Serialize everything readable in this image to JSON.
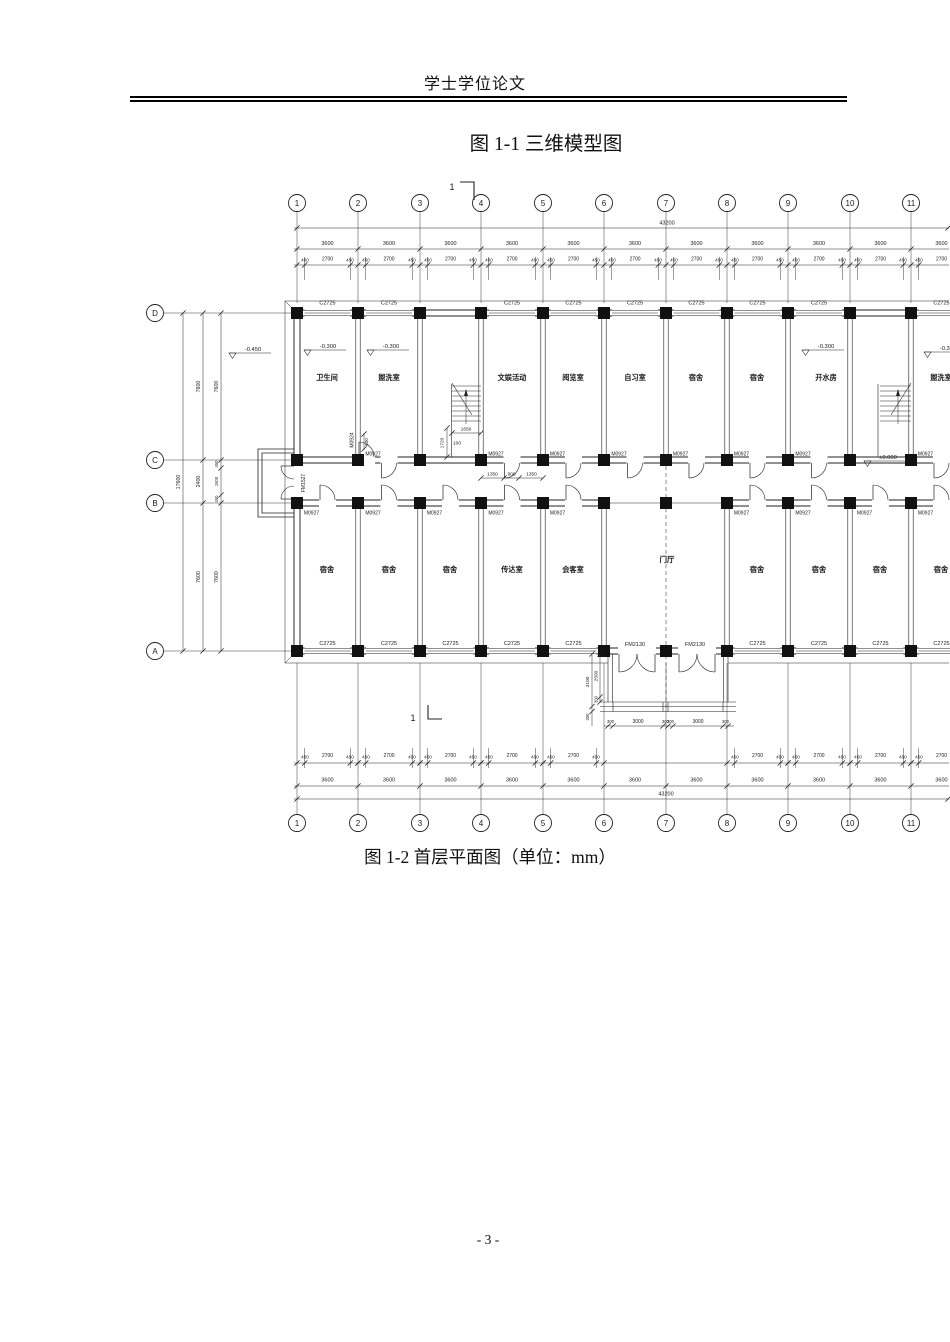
{
  "page": {
    "header_title": "学士学位论文",
    "figure1_caption": "图 1-1 三维模型图",
    "figure2_caption": "图 1-2 首层平面图（单位：mm）",
    "page_number": "- 3 -"
  },
  "plan": {
    "cols": [
      297,
      358,
      420,
      481,
      543,
      604,
      666,
      727,
      788,
      850,
      911,
      972
    ],
    "rows": {
      "D": 313,
      "C": 460,
      "B": 503,
      "A": 651
    },
    "grid_top_labels": [
      "1",
      "2",
      "3",
      "4",
      "5",
      "6",
      "7",
      "8",
      "9",
      "10",
      "11"
    ],
    "grid_left_labels": [
      "D",
      "C",
      "B",
      "A"
    ],
    "bubble_y_top": 203,
    "bubble_y_bottom": 823,
    "bubble_x_left": 155,
    "windows": {
      "label": "C2725",
      "top_centers": [
        327.5,
        389,
        512,
        573.5,
        635,
        696.5,
        757.5,
        819,
        941.5
      ],
      "bottom_centers": [
        327.5,
        389,
        450.5,
        512,
        573.5,
        757.5,
        819,
        880.5,
        941.5
      ]
    },
    "doors": {
      "label": "M0927",
      "c_wall_centers": [
        389,
        512,
        573.5,
        635,
        696.5,
        757.5,
        819,
        941.5
      ],
      "b_wall_centers": [
        327.5,
        389,
        450.5,
        512,
        573.5,
        757.5,
        819,
        880.5,
        941.5
      ]
    },
    "entry_doors": {
      "label": "FM2130",
      "centers": [
        637,
        697
      ]
    },
    "side_door_label": "FM1527",
    "aux_door_label": "M0924",
    "room_labels_top": [
      {
        "x": 327,
        "t": "卫生间"
      },
      {
        "x": 389,
        "t": "盥洗室"
      },
      {
        "x": 512,
        "t": "文娱活动"
      },
      {
        "x": 573,
        "t": "阅览室"
      },
      {
        "x": 635,
        "t": "自习室"
      },
      {
        "x": 696,
        "t": "宿舍"
      },
      {
        "x": 757,
        "t": "宿舍"
      },
      {
        "x": 826,
        "t": "开水房"
      },
      {
        "x": 941,
        "t": "盥洗室"
      }
    ],
    "room_labels_bottom": [
      {
        "x": 327,
        "t": "宿舍"
      },
      {
        "x": 389,
        "t": "宿舍"
      },
      {
        "x": 450,
        "t": "宿舍"
      },
      {
        "x": 512,
        "t": "传达室"
      },
      {
        "x": 573,
        "t": "会客室"
      },
      {
        "x": 757,
        "t": "宿舍"
      },
      {
        "x": 819,
        "t": "宿舍"
      },
      {
        "x": 880,
        "t": "宿舍"
      },
      {
        "x": 941,
        "t": "宿舍"
      }
    ],
    "hall_label": {
      "x": 667,
      "y": 562,
      "t": "门厅"
    },
    "level_markers": [
      {
        "x": 229,
        "y": 353,
        "t": "-0.450"
      },
      {
        "x": 304,
        "y": 350,
        "t": "-0.300"
      },
      {
        "x": 367,
        "y": 350,
        "t": "-0.300"
      },
      {
        "x": 802,
        "y": 350,
        "t": "-0.300"
      },
      {
        "x": 864,
        "y": 461,
        "t": "±0.000"
      },
      {
        "x": 924,
        "y": 352,
        "t": "-0.300"
      }
    ],
    "dims": {
      "total": "43200",
      "bay": "3600",
      "sub_side": "450",
      "sub_mid": "2700",
      "left": {
        "total": "17600",
        "rows": [
          "7600",
          "2400",
          "7600"
        ],
        "inner": [
          "7600",
          "450",
          "1500",
          "450",
          "7600"
        ]
      },
      "stair": {
        "w": "1650",
        "tread": "100",
        "h": "1720",
        "door_off": "600"
      },
      "corridor": [
        "1350",
        "900",
        "1350"
      ],
      "porch_h": [
        "300",
        "3000",
        "300",
        "300",
        "3000",
        "300"
      ],
      "porch_v": [
        "3100",
        "2500",
        "300",
        "300"
      ]
    },
    "bottom_sub_bays": [
      0,
      1,
      2,
      3,
      4,
      7,
      8,
      9,
      10
    ],
    "section_mark": "1"
  }
}
